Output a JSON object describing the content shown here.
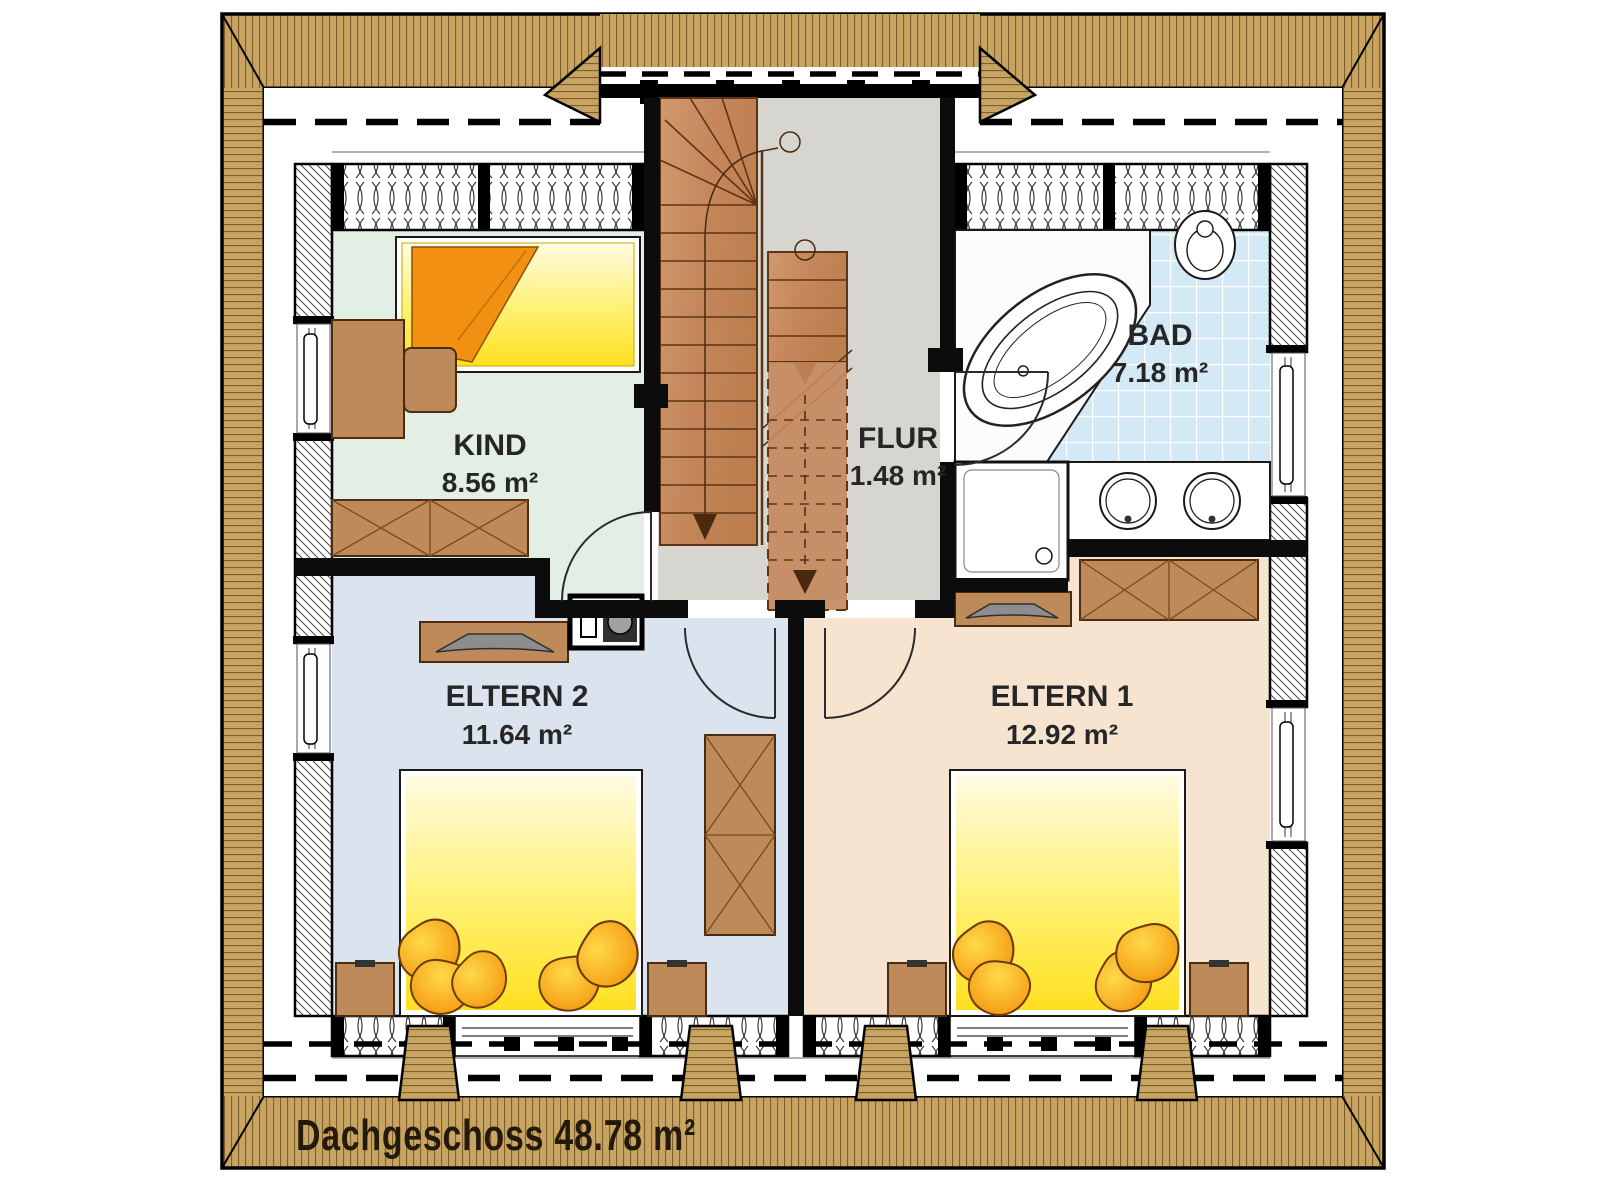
{
  "plan": {
    "title_label": "Dachgeschoss 48.78 m²",
    "rooms": {
      "kind": {
        "name": "KIND",
        "area": "8.56 m²",
        "floor_color": "#e3efe4"
      },
      "flur": {
        "name": "FLUR",
        "area": "1.48 m²",
        "floor_color": "#d6d5cf"
      },
      "bad": {
        "name": "BAD",
        "area": "7.18 m²",
        "floor_color": "#d4e9f6"
      },
      "eltern2": {
        "name": "ELTERN 2",
        "area": "11.64 m²",
        "floor_color": "#dbe3ee"
      },
      "eltern1": {
        "name": "ELTERN 1",
        "area": "12.92 m²",
        "floor_color": "#f6e4d0"
      }
    },
    "colors": {
      "roof_wood": "#c8a462",
      "stair_wood": "#c5875b",
      "furniture_wood": "#bf8a59",
      "bed_yellow": "#ffdf1f",
      "pillow_orange": "#f49d15",
      "tile_blue": "#d4e9f6",
      "label_text": "#262626",
      "title_text": "#241a0c"
    }
  }
}
